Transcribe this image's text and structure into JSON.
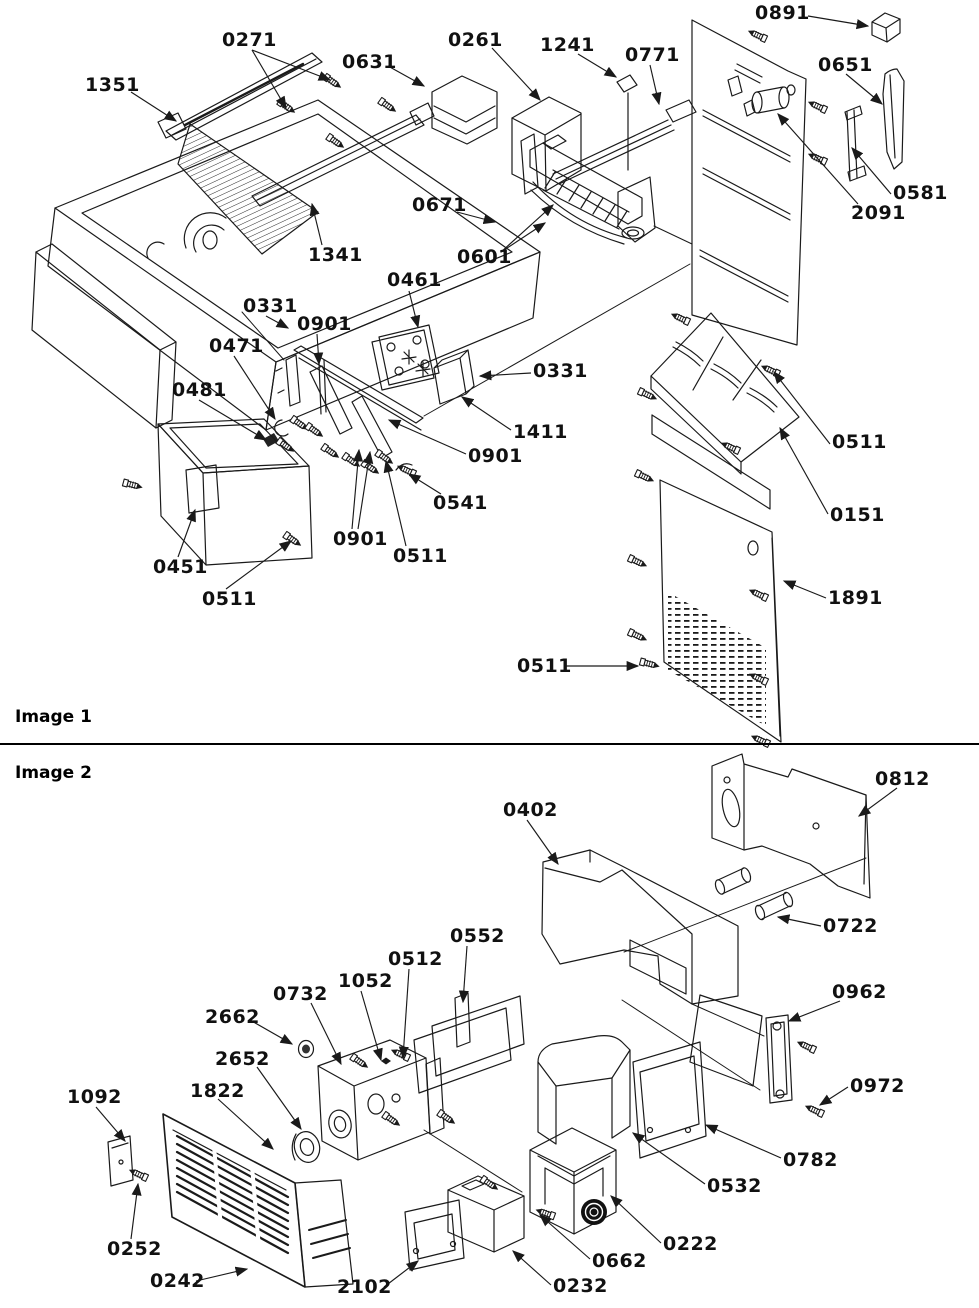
{
  "meta": {
    "background": "#ffffff",
    "ink": "#111111",
    "line_color": "#1a1a1a"
  },
  "sections": [
    {
      "id": "image1",
      "title": "Image 1",
      "labels": [
        {
          "text": "0891",
          "x": 755,
          "y": 4,
          "leaders": [
            [
              808,
              16,
              868,
              26
            ]
          ]
        },
        {
          "text": "0271",
          "x": 222,
          "y": 31,
          "leaders": [
            [
              252,
              50,
              286,
              108
            ],
            [
              252,
              50,
              330,
              80
            ]
          ]
        },
        {
          "text": "0261",
          "x": 448,
          "y": 31,
          "leaders": [
            [
              492,
              48,
              540,
              100
            ]
          ]
        },
        {
          "text": "1241",
          "x": 540,
          "y": 36,
          "leaders": [
            [
              578,
              54,
              616,
              77
            ]
          ]
        },
        {
          "text": "0771",
          "x": 625,
          "y": 46,
          "leaders": [
            [
              650,
              65,
              659,
              104
            ]
          ]
        },
        {
          "text": "0651",
          "x": 818,
          "y": 56,
          "leaders": [
            [
              846,
              74,
              882,
              104
            ]
          ]
        },
        {
          "text": "0631",
          "x": 342,
          "y": 53,
          "leaders": [
            [
              388,
              66,
              424,
              86
            ]
          ]
        },
        {
          "text": "1351",
          "x": 85,
          "y": 76,
          "leaders": [
            [
              131,
              92,
              176,
              121
            ]
          ]
        },
        {
          "text": "0581",
          "x": 893,
          "y": 184,
          "leaders": [
            [
              891,
              194,
              852,
              148
            ]
          ]
        },
        {
          "text": "2091",
          "x": 851,
          "y": 204,
          "leaders": [
            [
              858,
              204,
              778,
              114
            ]
          ]
        },
        {
          "text": "0671",
          "x": 412,
          "y": 196,
          "leaders": [
            [
              457,
              212,
              495,
              222
            ]
          ]
        },
        {
          "text": "0601",
          "x": 457,
          "y": 248,
          "leaders": [
            [
              501,
              252,
              545,
              223
            ],
            [
              501,
              252,
              553,
              205
            ]
          ]
        },
        {
          "text": "1341",
          "x": 308,
          "y": 246,
          "leaders": [
            [
              322,
              245,
              312,
              204
            ]
          ]
        },
        {
          "text": "0461",
          "x": 387,
          "y": 271,
          "leaders": [
            [
              409,
              291,
              418,
              327
            ]
          ]
        },
        {
          "text": "0331",
          "x": 243,
          "y": 297,
          "leaders": [
            [
              266,
              316,
              288,
              328
            ]
          ]
        },
        {
          "text": "0901",
          "x": 297,
          "y": 315,
          "leaders": [
            [
              317,
              334,
              319,
              364
            ]
          ]
        },
        {
          "text": "0471",
          "x": 209,
          "y": 337,
          "leaders": [
            [
              234,
              356,
              275,
              419
            ]
          ]
        },
        {
          "text": "0331",
          "x": 533,
          "y": 362,
          "leaders": [
            [
              531,
              373,
              480,
              376
            ]
          ]
        },
        {
          "text": "0481",
          "x": 172,
          "y": 381,
          "leaders": [
            [
              199,
              400,
              266,
              440
            ]
          ]
        },
        {
          "text": "1411",
          "x": 513,
          "y": 423,
          "leaders": [
            [
              511,
              430,
              462,
              397
            ]
          ]
        },
        {
          "text": "0901",
          "x": 468,
          "y": 447,
          "leaders": [
            [
              466,
              454,
              389,
              420
            ]
          ]
        },
        {
          "text": "0541",
          "x": 433,
          "y": 494,
          "leaders": [
            [
              441,
              494,
              409,
              474
            ]
          ]
        },
        {
          "text": "0901",
          "x": 333,
          "y": 530,
          "leaders": [
            [
              352,
              529,
              359,
              450
            ],
            [
              358,
              529,
              370,
              452
            ]
          ]
        },
        {
          "text": "0511",
          "x": 393,
          "y": 547,
          "leaders": [
            [
              406,
              546,
              386,
              461
            ]
          ]
        },
        {
          "text": "0451",
          "x": 153,
          "y": 558,
          "leaders": [
            [
              178,
              557,
              195,
              510
            ]
          ]
        },
        {
          "text": "0511",
          "x": 202,
          "y": 590,
          "leaders": [
            [
              226,
              589,
              291,
              541
            ]
          ]
        },
        {
          "text": "0511",
          "x": 832,
          "y": 433,
          "leaders": [
            [
              830,
              444,
              774,
              372
            ]
          ]
        },
        {
          "text": "0151",
          "x": 830,
          "y": 506,
          "leaders": [
            [
              828,
              514,
              780,
              428
            ]
          ]
        },
        {
          "text": "1891",
          "x": 828,
          "y": 589,
          "leaders": [
            [
              826,
              598,
              784,
              581
            ]
          ]
        },
        {
          "text": "0511",
          "x": 517,
          "y": 657,
          "leaders": [
            [
              564,
              666,
              638,
              666
            ]
          ]
        }
      ]
    },
    {
      "id": "image2",
      "title": "Image 2",
      "labels": [
        {
          "text": "0812",
          "x": 875,
          "y": 770,
          "leaders": [
            [
              897,
              788,
              859,
              816
            ]
          ]
        },
        {
          "text": "0402",
          "x": 503,
          "y": 801,
          "leaders": [
            [
              527,
              820,
              558,
              864
            ]
          ]
        },
        {
          "text": "0722",
          "x": 823,
          "y": 917,
          "leaders": [
            [
              821,
              926,
              778,
              917
            ]
          ]
        },
        {
          "text": "0962",
          "x": 832,
          "y": 983,
          "leaders": [
            [
              840,
              1001,
              789,
              1021
            ]
          ]
        },
        {
          "text": "0552",
          "x": 450,
          "y": 927,
          "leaders": [
            [
              467,
              946,
              463,
              1002
            ]
          ]
        },
        {
          "text": "0512",
          "x": 388,
          "y": 950,
          "leaders": [
            [
              409,
              969,
              403,
              1058
            ]
          ]
        },
        {
          "text": "1052",
          "x": 338,
          "y": 972,
          "leaders": [
            [
              361,
              991,
              381,
              1060
            ]
          ]
        },
        {
          "text": "0732",
          "x": 273,
          "y": 985,
          "leaders": [
            [
              311,
              1003,
              341,
              1064
            ]
          ]
        },
        {
          "text": "2662",
          "x": 205,
          "y": 1008,
          "leaders": [
            [
              250,
              1020,
              292,
              1044
            ]
          ]
        },
        {
          "text": "2652",
          "x": 215,
          "y": 1050,
          "leaders": [
            [
              257,
              1067,
              301,
              1129
            ]
          ]
        },
        {
          "text": "1822",
          "x": 190,
          "y": 1082,
          "leaders": [
            [
              218,
              1099,
              273,
              1149
            ]
          ]
        },
        {
          "text": "1092",
          "x": 67,
          "y": 1088,
          "leaders": [
            [
              96,
              1107,
              125,
              1141
            ]
          ]
        },
        {
          "text": "0972",
          "x": 850,
          "y": 1077,
          "leaders": [
            [
              848,
              1087,
              820,
              1105
            ]
          ]
        },
        {
          "text": "0782",
          "x": 783,
          "y": 1151,
          "leaders": [
            [
              781,
              1158,
              706,
              1125
            ]
          ]
        },
        {
          "text": "0532",
          "x": 707,
          "y": 1177,
          "leaders": [
            [
              705,
              1184,
              633,
              1133
            ]
          ]
        },
        {
          "text": "0252",
          "x": 107,
          "y": 1240,
          "leaders": [
            [
              131,
              1239,
              138,
              1184
            ]
          ]
        },
        {
          "text": "0222",
          "x": 663,
          "y": 1235,
          "leaders": [
            [
              661,
              1243,
              611,
              1196
            ]
          ]
        },
        {
          "text": "0662",
          "x": 592,
          "y": 1252,
          "leaders": [
            [
              590,
              1259,
              540,
              1215
            ]
          ]
        },
        {
          "text": "0242",
          "x": 150,
          "y": 1272,
          "leaders": [
            [
              196,
              1281,
              247,
              1269
            ]
          ]
        },
        {
          "text": "2102",
          "x": 337,
          "y": 1278,
          "leaders": [
            [
              384,
              1287,
              418,
              1261
            ]
          ]
        },
        {
          "text": "0232",
          "x": 553,
          "y": 1277,
          "leaders": [
            [
              551,
              1285,
              513,
              1251
            ]
          ]
        }
      ]
    }
  ]
}
